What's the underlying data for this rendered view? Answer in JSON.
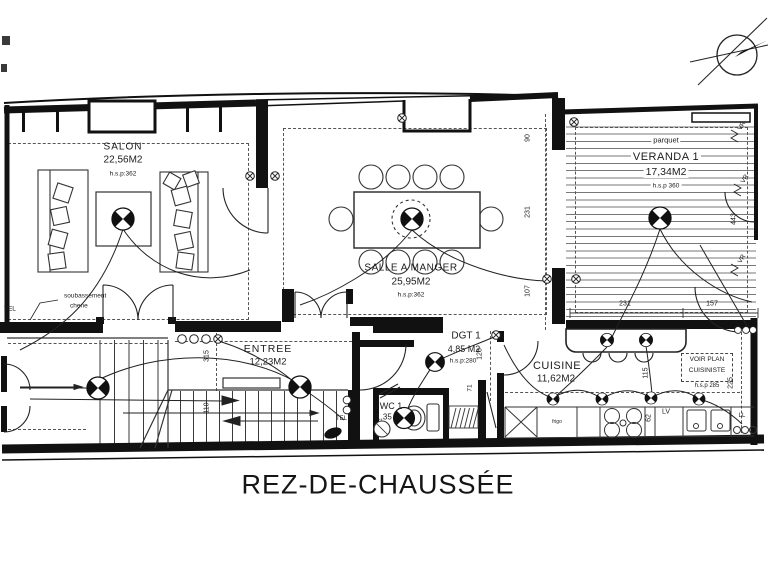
{
  "title": "REZ-DE-CHAUSSÉE",
  "rooms": {
    "salon": {
      "name": "SALON",
      "area": "22,56M2",
      "hsp": "h.s.p:362"
    },
    "salle_a_manger": {
      "name": "SALLE A MANGER",
      "area": "25,95M2",
      "hsp": "h.s.p:362"
    },
    "veranda": {
      "name": "VERANDA 1",
      "area": "17,34M2",
      "hsp": "h.s.p 360",
      "floor": "parquet"
    },
    "entree": {
      "name": "ENTREE",
      "area": "12,23M2"
    },
    "dgt": {
      "name": "DGT 1",
      "area": "4,85 M2",
      "hsp": "h.s.p:280"
    },
    "cuisine": {
      "name": "CUISINE",
      "area": "11,62M2"
    },
    "wc": {
      "name": "WC 1",
      "area": "1,35"
    }
  },
  "notes": {
    "soubassement_1": "soubassement",
    "soubassement_2": "chene",
    "tel": "TEL",
    "tel_2": "TEL",
    "voir_plan_1": "VOIR PLAN",
    "voir_plan_2": "CUISINISTE",
    "voir_plan_hsp": "h.s.p 285",
    "frigo": "frigo",
    "lave_vaisselle": "LV",
    "lave_linge": "LL",
    "volet_roulant": "VR"
  },
  "dimensions": {
    "d90": "90",
    "d231_wall": "231",
    "d107": "107",
    "d315": "315",
    "d110": "110",
    "d128": "128",
    "d71": "71",
    "d115": "115",
    "d62": "62",
    "d225": "225",
    "d231_veranda": "231",
    "d157": "157",
    "d443": "443"
  },
  "colors": {
    "ink": "#1a1a1a",
    "paper": "#ffffff"
  }
}
